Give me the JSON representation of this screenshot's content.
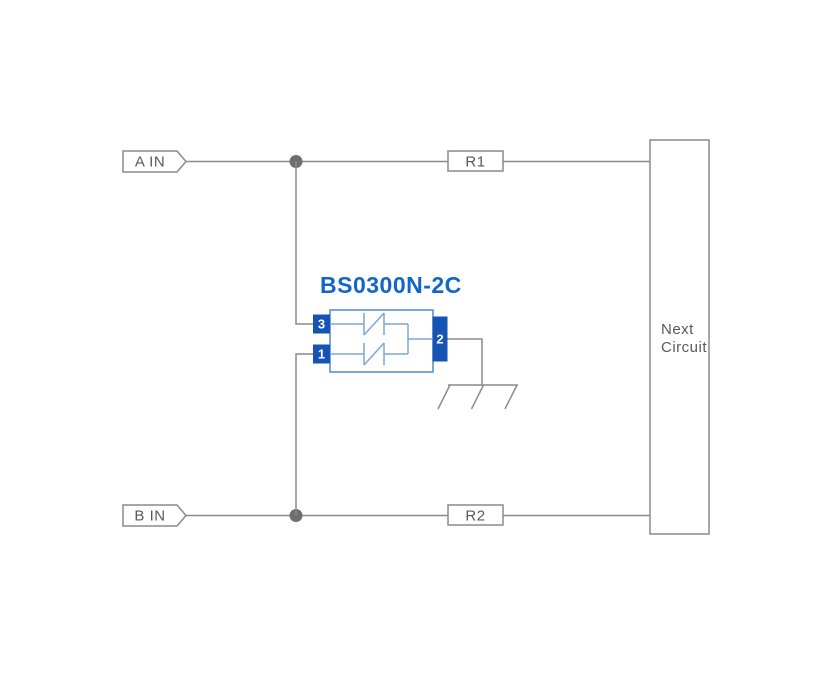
{
  "canvas": {
    "width": 832,
    "height": 675
  },
  "diagram": {
    "title": "BS0300N-2C",
    "input_a": "A IN",
    "input_b": "B IN",
    "resistor_r1": "R1",
    "resistor_r2": "R2",
    "pin_3": "3",
    "pin_1": "1",
    "pin_2": "2",
    "next_circuit_line1": "Next",
    "next_circuit_line2": "Circuit",
    "colors": {
      "background": "#ffffff",
      "wire": "#8a8a8a",
      "junction": "#6e6e6e",
      "text_gray": "#595959",
      "pin_fill": "#1553b5",
      "body_border": "#4f88d4",
      "symbol_stroke": "#7da6db",
      "label_blue": "#1266c8"
    }
  }
}
